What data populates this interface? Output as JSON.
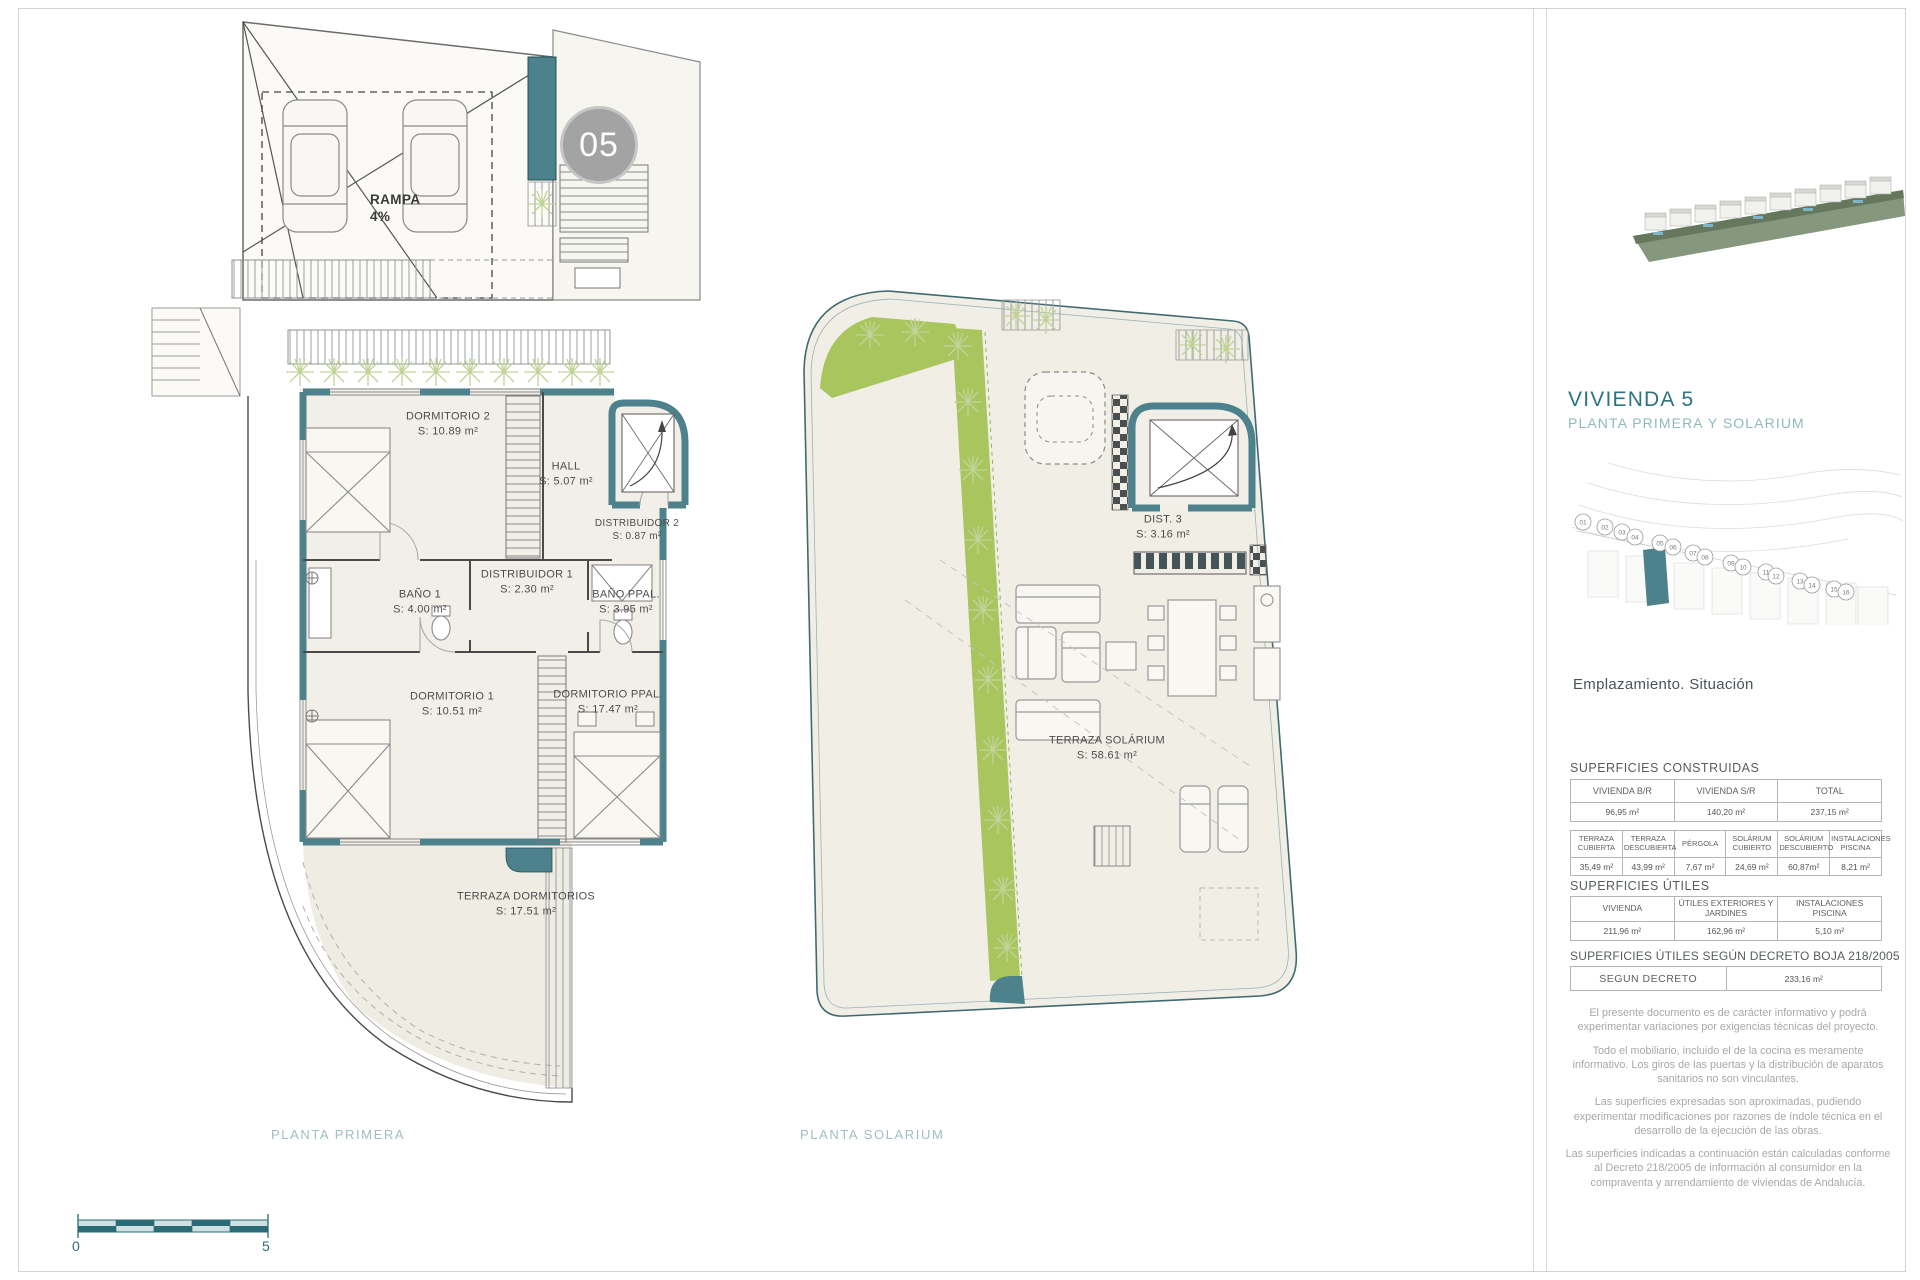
{
  "badge": {
    "number": "05"
  },
  "plan1": {
    "caption": "PLANTA PRIMERA",
    "ramp": {
      "line1": "RAMPA",
      "line2": "4%"
    },
    "rooms": [
      {
        "name": "DORMITORIO 2",
        "area": "S: 10.89 m²"
      },
      {
        "name": "HALL",
        "area": "S: 5.07 m²"
      },
      {
        "name": "DISTRIBUIDOR 2",
        "area": "S: 0.87 m²"
      },
      {
        "name": "BAÑO 1",
        "area": "S: 4.00 m²"
      },
      {
        "name": "DISTRIBUIDOR 1",
        "area": "S: 2.30 m²"
      },
      {
        "name": "BAÑO PPAL.",
        "area": "S: 3.95 m²"
      },
      {
        "name": "DORMITORIO 1",
        "area": "S: 10.51 m²"
      },
      {
        "name": "DORMITORIO PPAL.",
        "area": "S: 17.47 m²"
      },
      {
        "name": "TERRAZA DORMITORIOS",
        "area": "S: 17.51 m²"
      }
    ]
  },
  "plan2": {
    "caption": "PLANTA SOLARIUM",
    "rooms": [
      {
        "name": "DIST. 3",
        "area": "S: 3.16 m²"
      },
      {
        "name": "TERRAZA SOLÁRIUM",
        "area": "S: 58.61 m²"
      }
    ]
  },
  "scalebar": {
    "start": "0",
    "end": "5"
  },
  "sidebar": {
    "title": "VIVIENDA 5",
    "subtitle": "PLANTA PRIMERA Y SOLARIUM",
    "site_caption": "Emplazamiento. Situación",
    "plots": [
      "01",
      "02",
      "03",
      "04",
      "05",
      "06",
      "07",
      "08",
      "09",
      "10",
      "11",
      "12",
      "13",
      "14",
      "15",
      "16"
    ],
    "sections": {
      "construidas": {
        "heading": "SUPERFICIES CONSTRUIDAS",
        "table1": {
          "headers": [
            "VIVIENDA B/R",
            "VIVIENDA S/R",
            "TOTAL"
          ],
          "values": [
            "96,95 m²",
            "140,20 m²",
            "237,15 m²"
          ]
        },
        "table2": {
          "headers": [
            "TERRAZA CUBIERTA",
            "TERRAZA DESCUBIERTA",
            "PÉRGOLA",
            "SOLÁRIUM CUBIERTO",
            "SOLÁRIUM DESCUBIERTO",
            "INSTALACIONES PISCINA"
          ],
          "values": [
            "35,49 m²",
            "43,99 m²",
            "7,67 m²",
            "24,69 m²",
            "60,87m²",
            "8,21 m²"
          ]
        }
      },
      "utiles": {
        "heading": "SUPERFICIES ÚTILES",
        "table": {
          "headers": [
            "VIVIENDA",
            "ÚTILES EXTERIORES Y JARDINES",
            "INSTALACIONES PISCINA"
          ],
          "values": [
            "211,96 m²",
            "162,96 m²",
            "5,10 m²"
          ]
        }
      },
      "decreto": {
        "heading": "SUPERFICIES ÚTILES SEGÚN DECRETO BOJA 218/2005",
        "table": {
          "headers": [
            "SEGUN DECRETO"
          ],
          "values": [
            "233,16 m²"
          ]
        }
      }
    },
    "disclaimers": [
      "El presente documento es de carácter informativo y podrá experimentar variaciones por exigencias técnicas del proyecto.",
      "Todo el mobiliario, incluido el de la cocina es meramente informativo. Los giros de las puertas y la distribución de aparatos sanitarios no son vinculantes.",
      "Las superficies expresadas son aproximadas, pudiendo experimentar modificaciones por razones de índole técnica en el desarrollo de la ejecución de las obras.",
      "Las superficies indicadas a continuación están calculadas conforme al Decreto 218/2005 de información al consumidor en la compraventa y arrendamiento de viviendas de Andalucía."
    ]
  }
}
